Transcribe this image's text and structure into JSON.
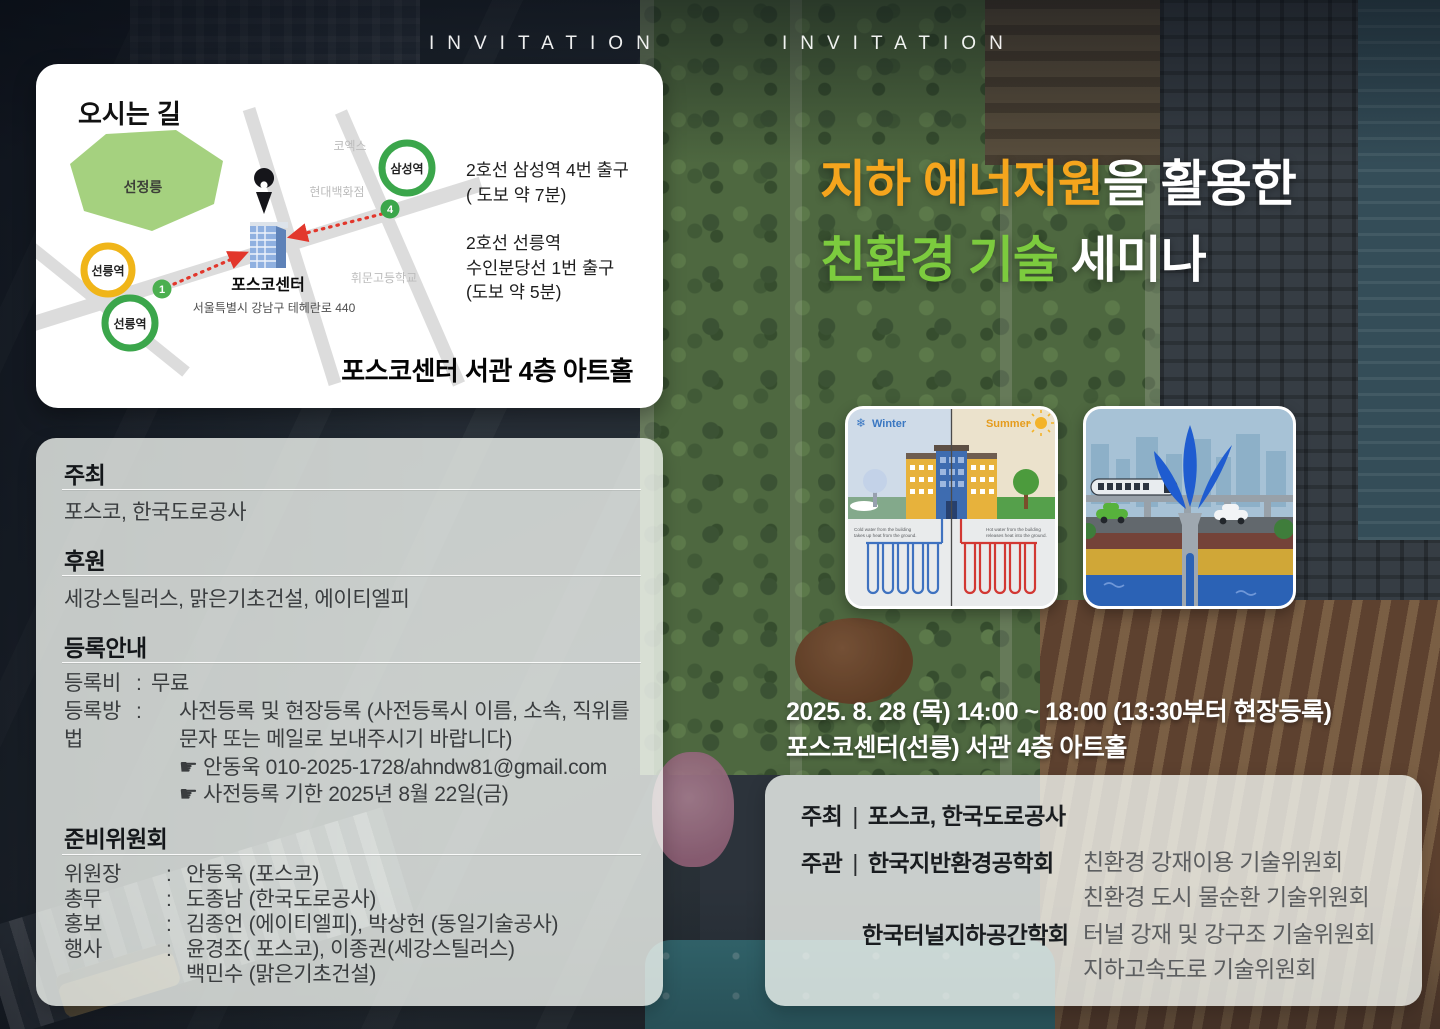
{
  "punct": {
    "colon": ":",
    "bar": "|"
  },
  "header": {
    "invitation_left": "INVITATION",
    "invitation_right": "INVITATION"
  },
  "map_card": {
    "title": "오시는 길",
    "map": {
      "park_label": "선정릉",
      "coex_label": "코엑스",
      "hyundai_label": "현대백화점",
      "whimoon_label": "휘문고등학교",
      "samseong_station": "삼성역",
      "seolleung_station_bundang": "선릉역",
      "seolleung_station_line2": "선릉역",
      "exit_4": "4",
      "exit_1": "1",
      "building_label": "포스코센터",
      "building_address": "서울특별시 강남구 테헤란로 440",
      "colors": {
        "line2_green": "#3BA64B",
        "suin_bundang_yellow": "#F0B519",
        "route_red": "#E2372C",
        "park_green": "#A5D17F",
        "road_gray": "#DCDCDC"
      }
    },
    "directions": {
      "samseong_line1": "2호선 삼성역 4번 출구",
      "samseong_line2": "( 도보 약 7분)",
      "seolleung_line1": "2호선 선릉역",
      "seolleung_line2": "수인분당선 1번 출구",
      "seolleung_line3": "(도보 약 5분)"
    },
    "venue": "포스코센터 서관 4층 아트홀"
  },
  "title": {
    "line1_highlight": "지하 에너지원",
    "line1_rest": "을 활용한",
    "line2_highlight": "친환경 기술",
    "line2_rest": " 세미나",
    "colors": {
      "line1_highlight": "#F5A51D",
      "line2_highlight": "#7CCB3E",
      "rest": "#FFFFFF"
    }
  },
  "diagrams": {
    "geothermal": {
      "winter_icon": "❄",
      "winter_label": "Winter",
      "summer_label": "Summer",
      "winter_caption_line1": "Cold water from the building",
      "winter_caption_line2": "takes up heat from the ground.",
      "summer_caption_line1": "Hot water from the building",
      "summer_caption_line2": "releases heat into the ground."
    }
  },
  "event": {
    "datetime_line": "2025. 8. 28 (목)  14:00 ~ 18:00  (13:30부터 현장등록)",
    "venue_line": "포스코센터(선릉) 서관 4층 아트홀"
  },
  "left_panel": {
    "host": {
      "title": "주최",
      "value": "포스코, 한국도로공사"
    },
    "sponsor": {
      "title": "후원",
      "value": "세강스틸러스, 맑은기초건설, 에이티엘피"
    },
    "registration": {
      "title": "등록안내",
      "fee_label": "등록비",
      "fee_value": "무료",
      "method_label": "등록방법",
      "method_line1": "사전등록 및 현장등록 (사전등록시 이름, 소속, 직위를",
      "method_line2": "문자 또는 메일로 보내주시기 바랍니다)",
      "contact_line": "☛ 안동욱   010-2025-1728/ahndw81@gmail.com",
      "deadline_line": "☛ 사전등록 기한   2025년 8월 22일(금)"
    },
    "committee": {
      "title": "준비위원회",
      "rows": [
        {
          "role": "위원장",
          "value": "안동욱 (포스코)"
        },
        {
          "role": "총무",
          "value": "도종남 (한국도로공사)"
        },
        {
          "role": "홍보",
          "value": "김종언 (에이티엘피), 박상헌 (동일기술공사)"
        },
        {
          "role": "행사",
          "value": "윤경조( 포스코), 이종권(세강스틸러스)",
          "value2": "백민수 (맑은기초건설)"
        }
      ]
    }
  },
  "right_panel": {
    "host_label": "주최",
    "host_value": "포스코, 한국도로공사",
    "organizer_label": "주관",
    "org1_name": "한국지반환경공학회",
    "org1_committee1": "친환경 강재이용 기술위원회",
    "org1_committee2": "친환경 도시 물순환 기술위원회",
    "org2_name": "한국터널지하공간학회",
    "org2_committee1": "터널 강재 및 강구조 기술위원회",
    "org2_committee2": "지하고속도로 기술위원회"
  }
}
